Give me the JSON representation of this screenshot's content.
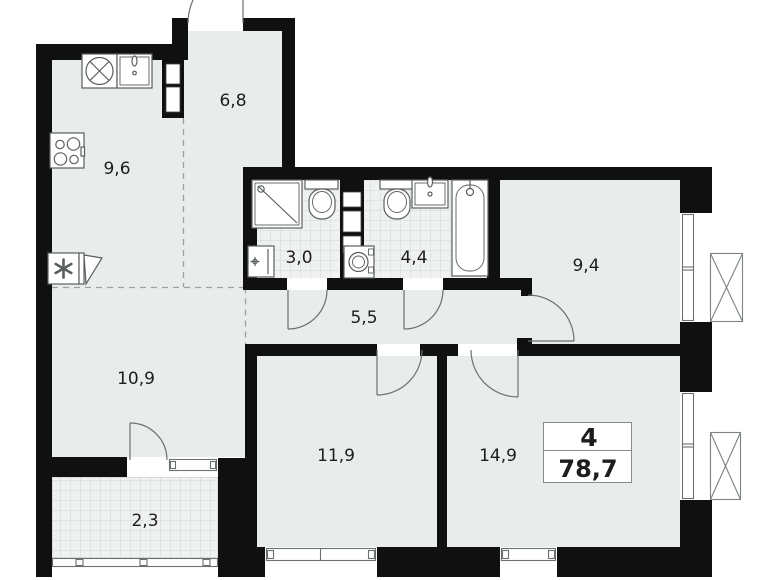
{
  "plan": {
    "badge": {
      "rooms_count": "4",
      "total_area": "78,7"
    },
    "rooms": {
      "kitchen": {
        "area": "9,6"
      },
      "hall": {
        "area": "6,8"
      },
      "bath_small": {
        "area": "3,0"
      },
      "bath_large": {
        "area": "4,4"
      },
      "bedroom_right": {
        "area": "9,4"
      },
      "corridor": {
        "area": "5,5"
      },
      "living": {
        "area": "10,9"
      },
      "bedroom_left": {
        "area": "11,9"
      },
      "bedroom_bottom": {
        "area": "14,9"
      },
      "balcony": {
        "area": "2,3"
      }
    },
    "colors": {
      "wall": "#101010",
      "floor": "#e8eceb",
      "tile_bg": "#f0f2f1",
      "tile_line": "#d2d7d6",
      "fixture": "#5a5f5f",
      "door": "#6b7070",
      "window": "#6b7070",
      "dash": "#9aa0a0",
      "label": "#1d1d1d",
      "badge_border": "#8a8a8a"
    }
  }
}
